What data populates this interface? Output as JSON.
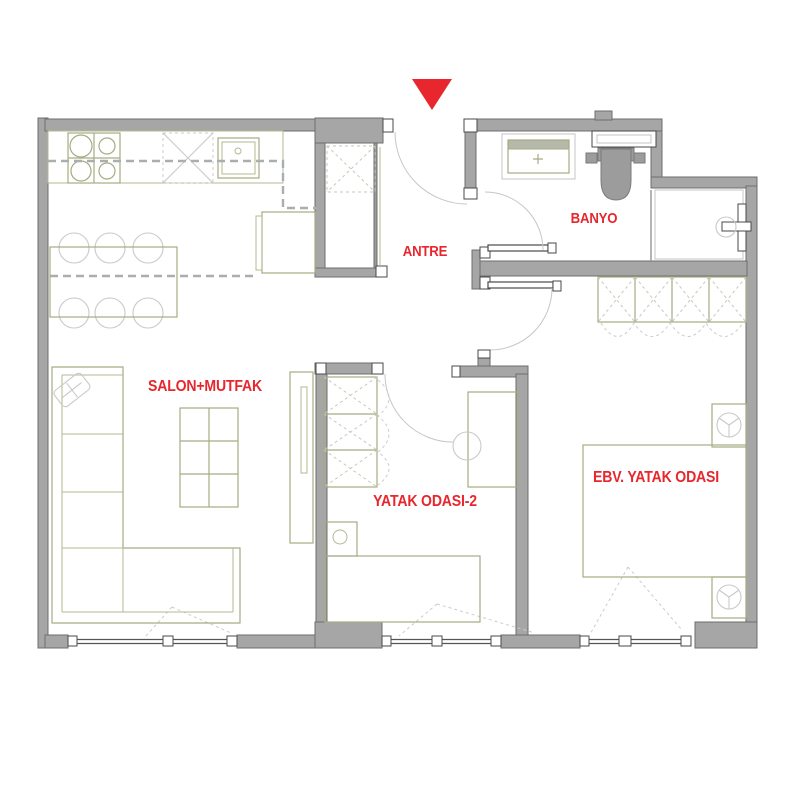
{
  "plan": {
    "kind": "apartment floor plan",
    "background": "#ffffff"
  },
  "colors": {
    "wall_gray": "#a6a6a6",
    "wall_edge": "#6e6e6e",
    "furniture_olive": "#a6ab82",
    "furniture_light_gray": "#c9c9c9",
    "beam_dashed_gray": "#a9aeae",
    "label_red": "#e8262d",
    "entrance_marker_red": "#e8262d",
    "door_frame_white": "#ffffff"
  },
  "entrance_marker": {
    "icon": "entrance-arrow-down",
    "color": "#e8262d"
  },
  "rooms": [
    {
      "id": "salon",
      "label": "SALON+MUTFAK"
    },
    {
      "id": "antre",
      "label": "ANTRE"
    },
    {
      "id": "banyo",
      "label": "BANYO"
    },
    {
      "id": "yatak2",
      "label": "YATAK ODASI-2"
    },
    {
      "id": "ebv",
      "label": "EBV. YATAK ODASI"
    }
  ],
  "furniture_icons": [
    "stove-4-burners-icon",
    "overhead-cabinet-x-icon",
    "kitchen-sink-icon",
    "kitchen-island-icon",
    "dining-table-icon",
    "dining-chairs-6-icon",
    "corner-sofa-icon",
    "throw-pillow-icon",
    "coffee-table-icon",
    "tv-unit-icon",
    "utility-shaft-x-icon",
    "wardrobe-3-section-icon",
    "wardrobe-4-section-icon",
    "single-bed-icon",
    "double-bed-icon",
    "nightstand-lamp-icon",
    "desk-icon",
    "desk-chair-icon",
    "vanity-sink-icon",
    "mirror-shelf-icon",
    "toilet-icon",
    "shower-set-icon",
    "door-swing-arc",
    "window-triple-pane"
  ]
}
